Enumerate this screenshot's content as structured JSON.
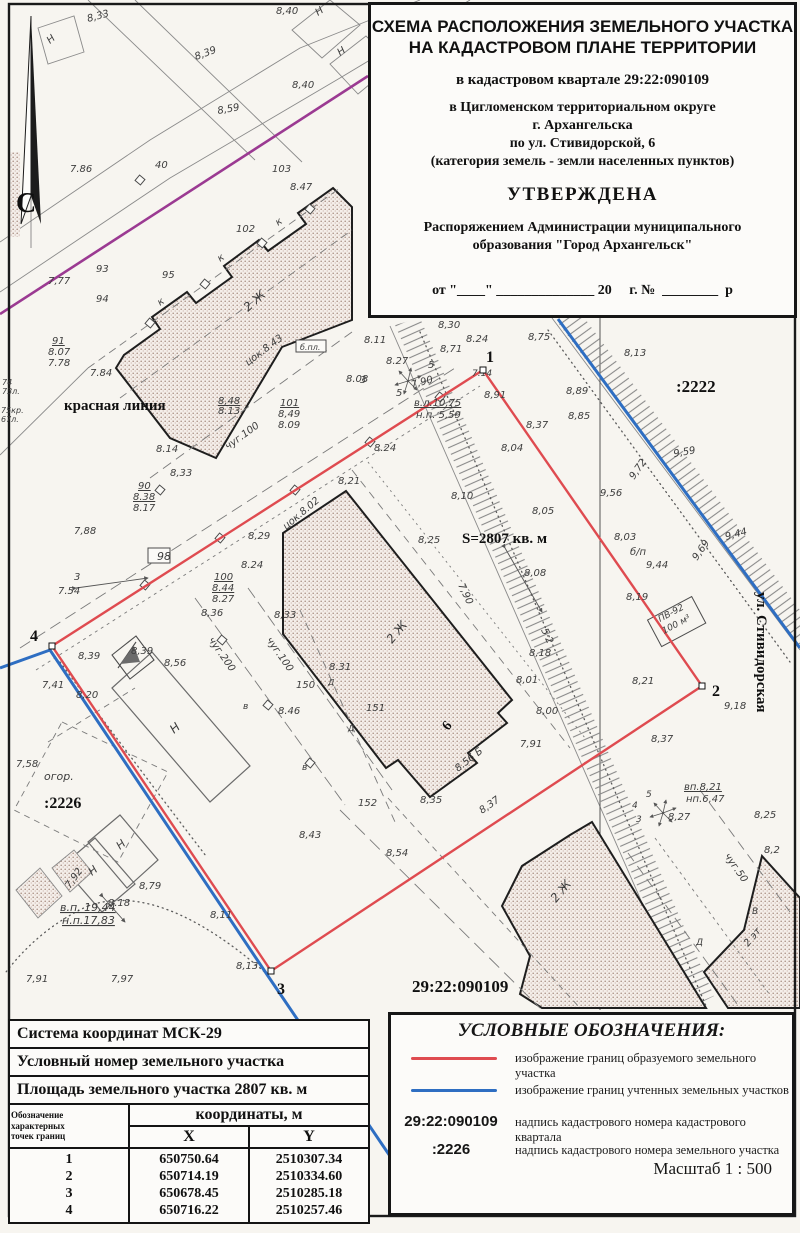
{
  "title_block": {
    "line1": "СХЕМА РАСПОЛОЖЕНИЯ ЗЕМЕЛЬНОГО УЧАСТКА",
    "line2": "НА КАДАСТРОВОМ ПЛАНЕ ТЕРРИТОРИИ",
    "quarter": "в кадастровом квартале 29:22:090109",
    "district1": "в Цигломенском территориальном округе",
    "district2": "г. Архангельска",
    "district3": "по ул. Стивидорской, 6",
    "district4": "(категория земель - земли населенных пунктов)",
    "approved": "УТВЕРЖДЕНА",
    "order1": "Распоряжением Администрации муниципального",
    "order2": "образования \"Город Архангельск\"",
    "date_line": "от \"____\" ______________ 20     г. №  ________  р"
  },
  "coords_table": {
    "row1": "Система координат МСК-29",
    "row2": "Условный номер земельного участка",
    "row3": "Площадь земельного участка 2807 кв. м",
    "col_point": "Обозначение\nхарактерных\nточек границ",
    "col_coords": "координаты, м",
    "col_x": "X",
    "col_y": "Y",
    "points": [
      {
        "n": "1",
        "x": "650750.64",
        "y": "2510307.34"
      },
      {
        "n": "2",
        "x": "650714.19",
        "y": "2510334.60"
      },
      {
        "n": "3",
        "x": "650678.45",
        "y": "2510285.18"
      },
      {
        "n": "4",
        "x": "650716.22",
        "y": "2510257.46"
      }
    ]
  },
  "legend": {
    "title": "УСЛОВНЫЕ ОБОЗНАЧЕНИЯ:",
    "items": [
      {
        "type": "red-line",
        "symbol": "",
        "label": "изображение границ образуемого земельного участка"
      },
      {
        "type": "blue-line",
        "symbol": "",
        "label": "изображение границ учтенных земельных участков"
      },
      {
        "type": "text",
        "symbol": "29:22:090109",
        "label": "надпись кадастрового номера кадастрового квартала"
      },
      {
        "type": "text",
        "symbol": ":2226",
        "label": "надпись кадастрового номера земельного участка"
      }
    ],
    "scale": "Масштаб  1 : 500"
  },
  "colors": {
    "red": "#df4b50",
    "blue": "#2e6ec2",
    "magenta": "#9b3a92"
  },
  "map": {
    "north_label": "С",
    "points": [
      {
        "n": "1",
        "x": 483,
        "y": 370,
        "tx": 486,
        "ty": 362
      },
      {
        "n": "2",
        "x": 702,
        "y": 686,
        "tx": 712,
        "ty": 696
      },
      {
        "n": "3",
        "x": 271,
        "y": 971,
        "tx": 277,
        "ty": 994
      },
      {
        "n": "4",
        "x": 52,
        "y": 646,
        "tx": 30,
        "ty": 641
      }
    ],
    "labels": [
      {
        "t": "С",
        "x": 16,
        "y": 212,
        "s": 28,
        "k": "b"
      },
      {
        "t": "8,33",
        "x": 88,
        "y": 22,
        "r": -15
      },
      {
        "t": "Н",
        "x": 50,
        "y": 44,
        "r": -40
      },
      {
        "t": "Н",
        "x": 318,
        "y": 16,
        "r": -35
      },
      {
        "t": "8,40",
        "x": 276,
        "y": 14
      },
      {
        "t": "8,39",
        "x": 196,
        "y": 60,
        "r": -20
      },
      {
        "t": "8,59",
        "x": 218,
        "y": 114,
        "r": -10
      },
      {
        "t": "8,40",
        "x": 292,
        "y": 88
      },
      {
        "t": "Н",
        "x": 340,
        "y": 56,
        "r": -35
      },
      {
        "t": "7.86",
        "x": 70,
        "y": 172
      },
      {
        "t": "40",
        "x": 155,
        "y": 168
      },
      {
        "t": "103",
        "x": 272,
        "y": 172
      },
      {
        "t": "8.47",
        "x": 290,
        "y": 190
      },
      {
        "t": "102",
        "x": 236,
        "y": 232
      },
      {
        "t": "95",
        "x": 162,
        "y": 278
      },
      {
        "t": "93",
        "x": 96,
        "y": 272
      },
      {
        "t": "94",
        "x": 96,
        "y": 302
      },
      {
        "t": "7,77",
        "x": 48,
        "y": 284
      },
      {
        "t": "к",
        "x": 220,
        "y": 262,
        "r": -35
      },
      {
        "t": "к",
        "x": 160,
        "y": 306,
        "r": -35
      },
      {
        "t": "к",
        "x": 278,
        "y": 226,
        "r": -35
      },
      {
        "t": "91",
        "x": 52,
        "y": 344,
        "u": 1
      },
      {
        "t": "8.07",
        "x": 48,
        "y": 355
      },
      {
        "t": "7.78",
        "x": 48,
        "y": 366
      },
      {
        "t": "7.84",
        "x": 90,
        "y": 376
      },
      {
        "t": "74",
        "x": 2,
        "y": 385,
        "s": 8
      },
      {
        "t": "73л.",
        "x": 2,
        "y": 394,
        "s": 8
      },
      {
        "t": "75кр.",
        "x": 1,
        "y": 413,
        "s": 8
      },
      {
        "t": "67л.",
        "x": 1,
        "y": 422,
        "s": 8
      },
      {
        "t": "красная линия",
        "x": 64,
        "y": 410,
        "s": 15,
        "k": "b"
      },
      {
        "t": "2 Ж",
        "x": 248,
        "y": 312,
        "r": -42,
        "s": 12
      },
      {
        "t": "цок.8.43",
        "x": 248,
        "y": 366,
        "r": -37
      },
      {
        "t": "б.пл.",
        "x": 300,
        "y": 350,
        "s": 8
      },
      {
        "t": "8,48",
        "x": 218,
        "y": 404,
        "u": 1
      },
      {
        "t": "8.13",
        "x": 218,
        "y": 414
      },
      {
        "t": "101",
        "x": 280,
        "y": 406,
        "u": 1
      },
      {
        "t": "8,49",
        "x": 278,
        "y": 417
      },
      {
        "t": "8.09",
        "x": 278,
        "y": 428
      },
      {
        "t": "чуг.100",
        "x": 228,
        "y": 450,
        "r": -36
      },
      {
        "t": "8.14",
        "x": 156,
        "y": 452
      },
      {
        "t": "8,33",
        "x": 170,
        "y": 476
      },
      {
        "t": "90",
        "x": 138,
        "y": 489,
        "u": 1
      },
      {
        "t": "8.38",
        "x": 133,
        "y": 500,
        "u": 1
      },
      {
        "t": "8.17",
        "x": 133,
        "y": 511
      },
      {
        "t": "7,88",
        "x": 74,
        "y": 534
      },
      {
        "t": "98",
        "x": 157,
        "y": 560,
        "s": 11
      },
      {
        "t": "3",
        "x": 74,
        "y": 580
      },
      {
        "t": "7.54",
        "x": 58,
        "y": 594
      },
      {
        "t": "8,30",
        "x": 438,
        "y": 328
      },
      {
        "t": "8.24",
        "x": 466,
        "y": 342
      },
      {
        "t": "8,75",
        "x": 528,
        "y": 340
      },
      {
        "t": "8.11",
        "x": 364,
        "y": 343
      },
      {
        "t": "8,71",
        "x": 440,
        "y": 352
      },
      {
        "t": "8,13",
        "x": 624,
        "y": 356
      },
      {
        "t": ":2222",
        "x": 676,
        "y": 392,
        "s": 17,
        "k": "b"
      },
      {
        "t": "8,89",
        "x": 566,
        "y": 394
      },
      {
        "t": "8,85",
        "x": 568,
        "y": 419
      },
      {
        "t": "9,59",
        "x": 674,
        "y": 457,
        "r": -10
      },
      {
        "t": "9,72",
        "x": 634,
        "y": 480,
        "r": -55
      },
      {
        "t": "9,56",
        "x": 600,
        "y": 496
      },
      {
        "t": "8,03",
        "x": 614,
        "y": 540
      },
      {
        "t": "б/п",
        "x": 630,
        "y": 555
      },
      {
        "t": "9,44",
        "x": 646,
        "y": 568
      },
      {
        "t": "9,44",
        "x": 726,
        "y": 540,
        "r": -15
      },
      {
        "t": "9,69",
        "x": 697,
        "y": 561,
        "r": -55
      },
      {
        "t": "8,19",
        "x": 626,
        "y": 600
      },
      {
        "t": "ПВ-92",
        "x": 660,
        "y": 622,
        "r": -28,
        "s": 9
      },
      {
        "t": "100 м³",
        "x": 664,
        "y": 634,
        "r": -28,
        "s": 9
      },
      {
        "t": "ул. Стивидорская",
        "x": 757,
        "y": 592,
        "r": 90,
        "s": 15,
        "k": "b"
      },
      {
        "t": "7.14",
        "x": 472,
        "y": 376,
        "s": 9
      },
      {
        "t": "8.27",
        "x": 386,
        "y": 364
      },
      {
        "t": "3",
        "x": 360,
        "y": 383
      },
      {
        "t": "5",
        "x": 428,
        "y": 368
      },
      {
        "t": "5",
        "x": 396,
        "y": 396
      },
      {
        "t": "7,90",
        "x": 412,
        "y": 388,
        "r": -15
      },
      {
        "t": "8.08",
        "x": 346,
        "y": 382
      },
      {
        "t": "в.л.10,75",
        "x": 414,
        "y": 406,
        "u": 1
      },
      {
        "t": "н.п. 5,59",
        "x": 416,
        "y": 418
      },
      {
        "t": "8.24",
        "x": 374,
        "y": 451
      },
      {
        "t": "8,91",
        "x": 484,
        "y": 398
      },
      {
        "t": "8,04",
        "x": 501,
        "y": 451
      },
      {
        "t": "8,37",
        "x": 526,
        "y": 428
      },
      {
        "t": "8,10",
        "x": 451,
        "y": 499
      },
      {
        "t": "8,05",
        "x": 532,
        "y": 514
      },
      {
        "t": "S=2807 кв. м",
        "x": 462,
        "y": 543,
        "s": 15,
        "k": "b"
      },
      {
        "t": "8,25",
        "x": 418,
        "y": 543
      },
      {
        "t": "8,21",
        "x": 338,
        "y": 484
      },
      {
        "t": "8,29",
        "x": 248,
        "y": 539
      },
      {
        "t": "цок.8.02",
        "x": 286,
        "y": 530,
        "r": -40
      },
      {
        "t": "8.24",
        "x": 241,
        "y": 568
      },
      {
        "t": "100",
        "x": 214,
        "y": 580,
        "u": 1
      },
      {
        "t": "8.44",
        "x": 212,
        "y": 591,
        "u": 1
      },
      {
        "t": "8.27",
        "x": 212,
        "y": 602
      },
      {
        "t": "8,36",
        "x": 201,
        "y": 616
      },
      {
        "t": "8,33",
        "x": 274,
        "y": 618
      },
      {
        "t": "чуг.200",
        "x": 208,
        "y": 640,
        "r": 55
      },
      {
        "t": "чуг.100",
        "x": 266,
        "y": 640,
        "r": 55
      },
      {
        "t": "8,39",
        "x": 78,
        "y": 659
      },
      {
        "t": "8,39",
        "x": 131,
        "y": 654
      },
      {
        "t": "8,56",
        "x": 164,
        "y": 666
      },
      {
        "t": "8,20",
        "x": 76,
        "y": 698
      },
      {
        "t": "7,41",
        "x": 42,
        "y": 688
      },
      {
        "t": "7,58",
        "x": 16,
        "y": 767
      },
      {
        "t": "огор.",
        "x": 44,
        "y": 780,
        "s": 11
      },
      {
        "t": ":2226",
        "x": 44,
        "y": 808,
        "s": 16,
        "k": "b"
      },
      {
        "t": "Н",
        "x": 174,
        "y": 734,
        "r": -40,
        "s": 12
      },
      {
        "t": "Н",
        "x": 92,
        "y": 876,
        "r": -40,
        "s": 11
      },
      {
        "t": "Н",
        "x": 120,
        "y": 850,
        "r": -40,
        "s": 11
      },
      {
        "t": "7,90",
        "x": 458,
        "y": 585,
        "r": 65
      },
      {
        "t": "8,08",
        "x": 524,
        "y": 576
      },
      {
        "t": "5·2",
        "x": 541,
        "y": 630,
        "r": 65
      },
      {
        "t": "8,18",
        "x": 529,
        "y": 656
      },
      {
        "t": "8,01",
        "x": 516,
        "y": 683
      },
      {
        "t": "8,00",
        "x": 536,
        "y": 714
      },
      {
        "t": "7,91",
        "x": 520,
        "y": 747
      },
      {
        "t": "8.56 Б",
        "x": 458,
        "y": 772,
        "r": -38
      },
      {
        "t": "150",
        "x": 296,
        "y": 688
      },
      {
        "t": "151",
        "x": 366,
        "y": 711
      },
      {
        "t": "152",
        "x": 358,
        "y": 806
      },
      {
        "t": "Д",
        "x": 328,
        "y": 685,
        "s": 8
      },
      {
        "t": "Д",
        "x": 348,
        "y": 731,
        "s": 8
      },
      {
        "t": "8.31",
        "x": 329,
        "y": 670
      },
      {
        "t": "8.46",
        "x": 278,
        "y": 714
      },
      {
        "t": "8,35",
        "x": 420,
        "y": 803
      },
      {
        "t": "8,37",
        "x": 482,
        "y": 814,
        "r": -35
      },
      {
        "t": "2 Ж",
        "x": 392,
        "y": 644,
        "r": -50,
        "s": 12
      },
      {
        "t": "6",
        "x": 448,
        "y": 731,
        "r": -50,
        "s": 14,
        "k": "b"
      },
      {
        "t": "8,43",
        "x": 299,
        "y": 838
      },
      {
        "t": "8,54",
        "x": 386,
        "y": 856
      },
      {
        "t": "в",
        "x": 243,
        "y": 709,
        "s": 9
      },
      {
        "t": "в",
        "x": 302,
        "y": 770,
        "s": 9
      },
      {
        "t": "8,11",
        "x": 210,
        "y": 918
      },
      {
        "t": "7,92",
        "x": 70,
        "y": 889,
        "r": -55
      },
      {
        "t": "8,79",
        "x": 139,
        "y": 889
      },
      {
        "t": "в.п. 19,44",
        "x": 60,
        "y": 911,
        "s": 11,
        "u": 1
      },
      {
        "t": "н.п.17,83",
        "x": 62,
        "y": 924,
        "s": 11,
        "u": 1
      },
      {
        "t": "8.18",
        "x": 108,
        "y": 906
      },
      {
        "t": "7,91",
        "x": 26,
        "y": 982
      },
      {
        "t": "7,97",
        "x": 111,
        "y": 982
      },
      {
        "t": "8,13",
        "x": 236,
        "y": 969
      },
      {
        "t": "29:22:090109",
        "x": 412,
        "y": 992,
        "s": 17,
        "k": "b"
      },
      {
        "t": "2 Ж",
        "x": 556,
        "y": 903,
        "r": -50,
        "s": 12
      },
      {
        "t": "2 эт",
        "x": 748,
        "y": 947,
        "r": -50,
        "s": 10
      },
      {
        "t": "8,21",
        "x": 632,
        "y": 684
      },
      {
        "t": "9,18",
        "x": 724,
        "y": 709
      },
      {
        "t": "8,37",
        "x": 651,
        "y": 742
      },
      {
        "t": "вп.8,21",
        "x": 684,
        "y": 790,
        "u": 1
      },
      {
        "t": "нп.6,47",
        "x": 686,
        "y": 802
      },
      {
        "t": "8,27",
        "x": 668,
        "y": 820
      },
      {
        "t": "5",
        "x": 646,
        "y": 797,
        "s": 9
      },
      {
        "t": "4",
        "x": 632,
        "y": 808,
        "s": 9
      },
      {
        "t": "3",
        "x": 636,
        "y": 822,
        "s": 9
      },
      {
        "t": "8,25",
        "x": 754,
        "y": 818
      },
      {
        "t": "8,2",
        "x": 764,
        "y": 853
      },
      {
        "t": "чуг.50",
        "x": 724,
        "y": 856,
        "r": 55
      },
      {
        "t": "Д",
        "x": 696,
        "y": 945,
        "s": 9
      },
      {
        "t": "В",
        "x": 752,
        "y": 914,
        "s": 9
      }
    ]
  }
}
